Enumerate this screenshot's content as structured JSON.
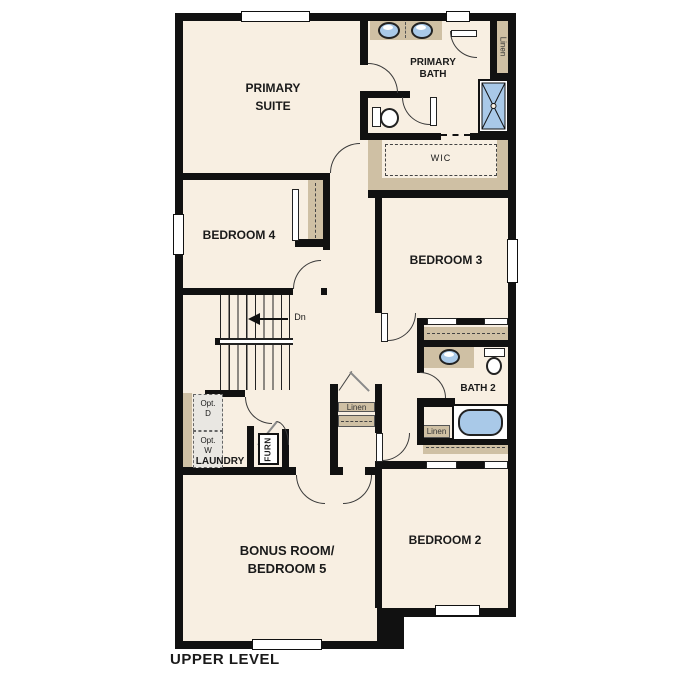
{
  "plan": {
    "title": "UPPER LEVEL",
    "rooms": {
      "primary_suite": {
        "line1": "PRIMARY",
        "line2": "SUITE"
      },
      "primary_bath": {
        "line1": "PRIMARY",
        "line2": "BATH"
      },
      "wic": "WIC",
      "bedroom4": "BEDROOM 4",
      "bedroom3": "BEDROOM 3",
      "bath2": "BATH 2",
      "bedroom2": "BEDROOM 2",
      "bonus": {
        "line1": "BONUS ROOM/",
        "line2": "BEDROOM 5"
      },
      "laundry": "LAUNDRY"
    },
    "closets": {
      "linen_primary": "Linen",
      "linen_hall": "Linen",
      "linen_bath2": "Linen",
      "furnace": "FURN"
    },
    "stairs": {
      "direction_label": "Dn"
    },
    "appliances": {
      "dryer": {
        "line1": "Opt.",
        "line2": "D"
      },
      "washer": {
        "line1": "Opt.",
        "line2": "W"
      }
    },
    "colors": {
      "wall": "#111111",
      "floor": "#f8efe2",
      "casework": "#cfc0a4",
      "fixture_blue": "#a9c9e8",
      "appliance_gray": "#e9e7e2",
      "background": "#ffffff",
      "text": "#1a1a1a"
    }
  }
}
